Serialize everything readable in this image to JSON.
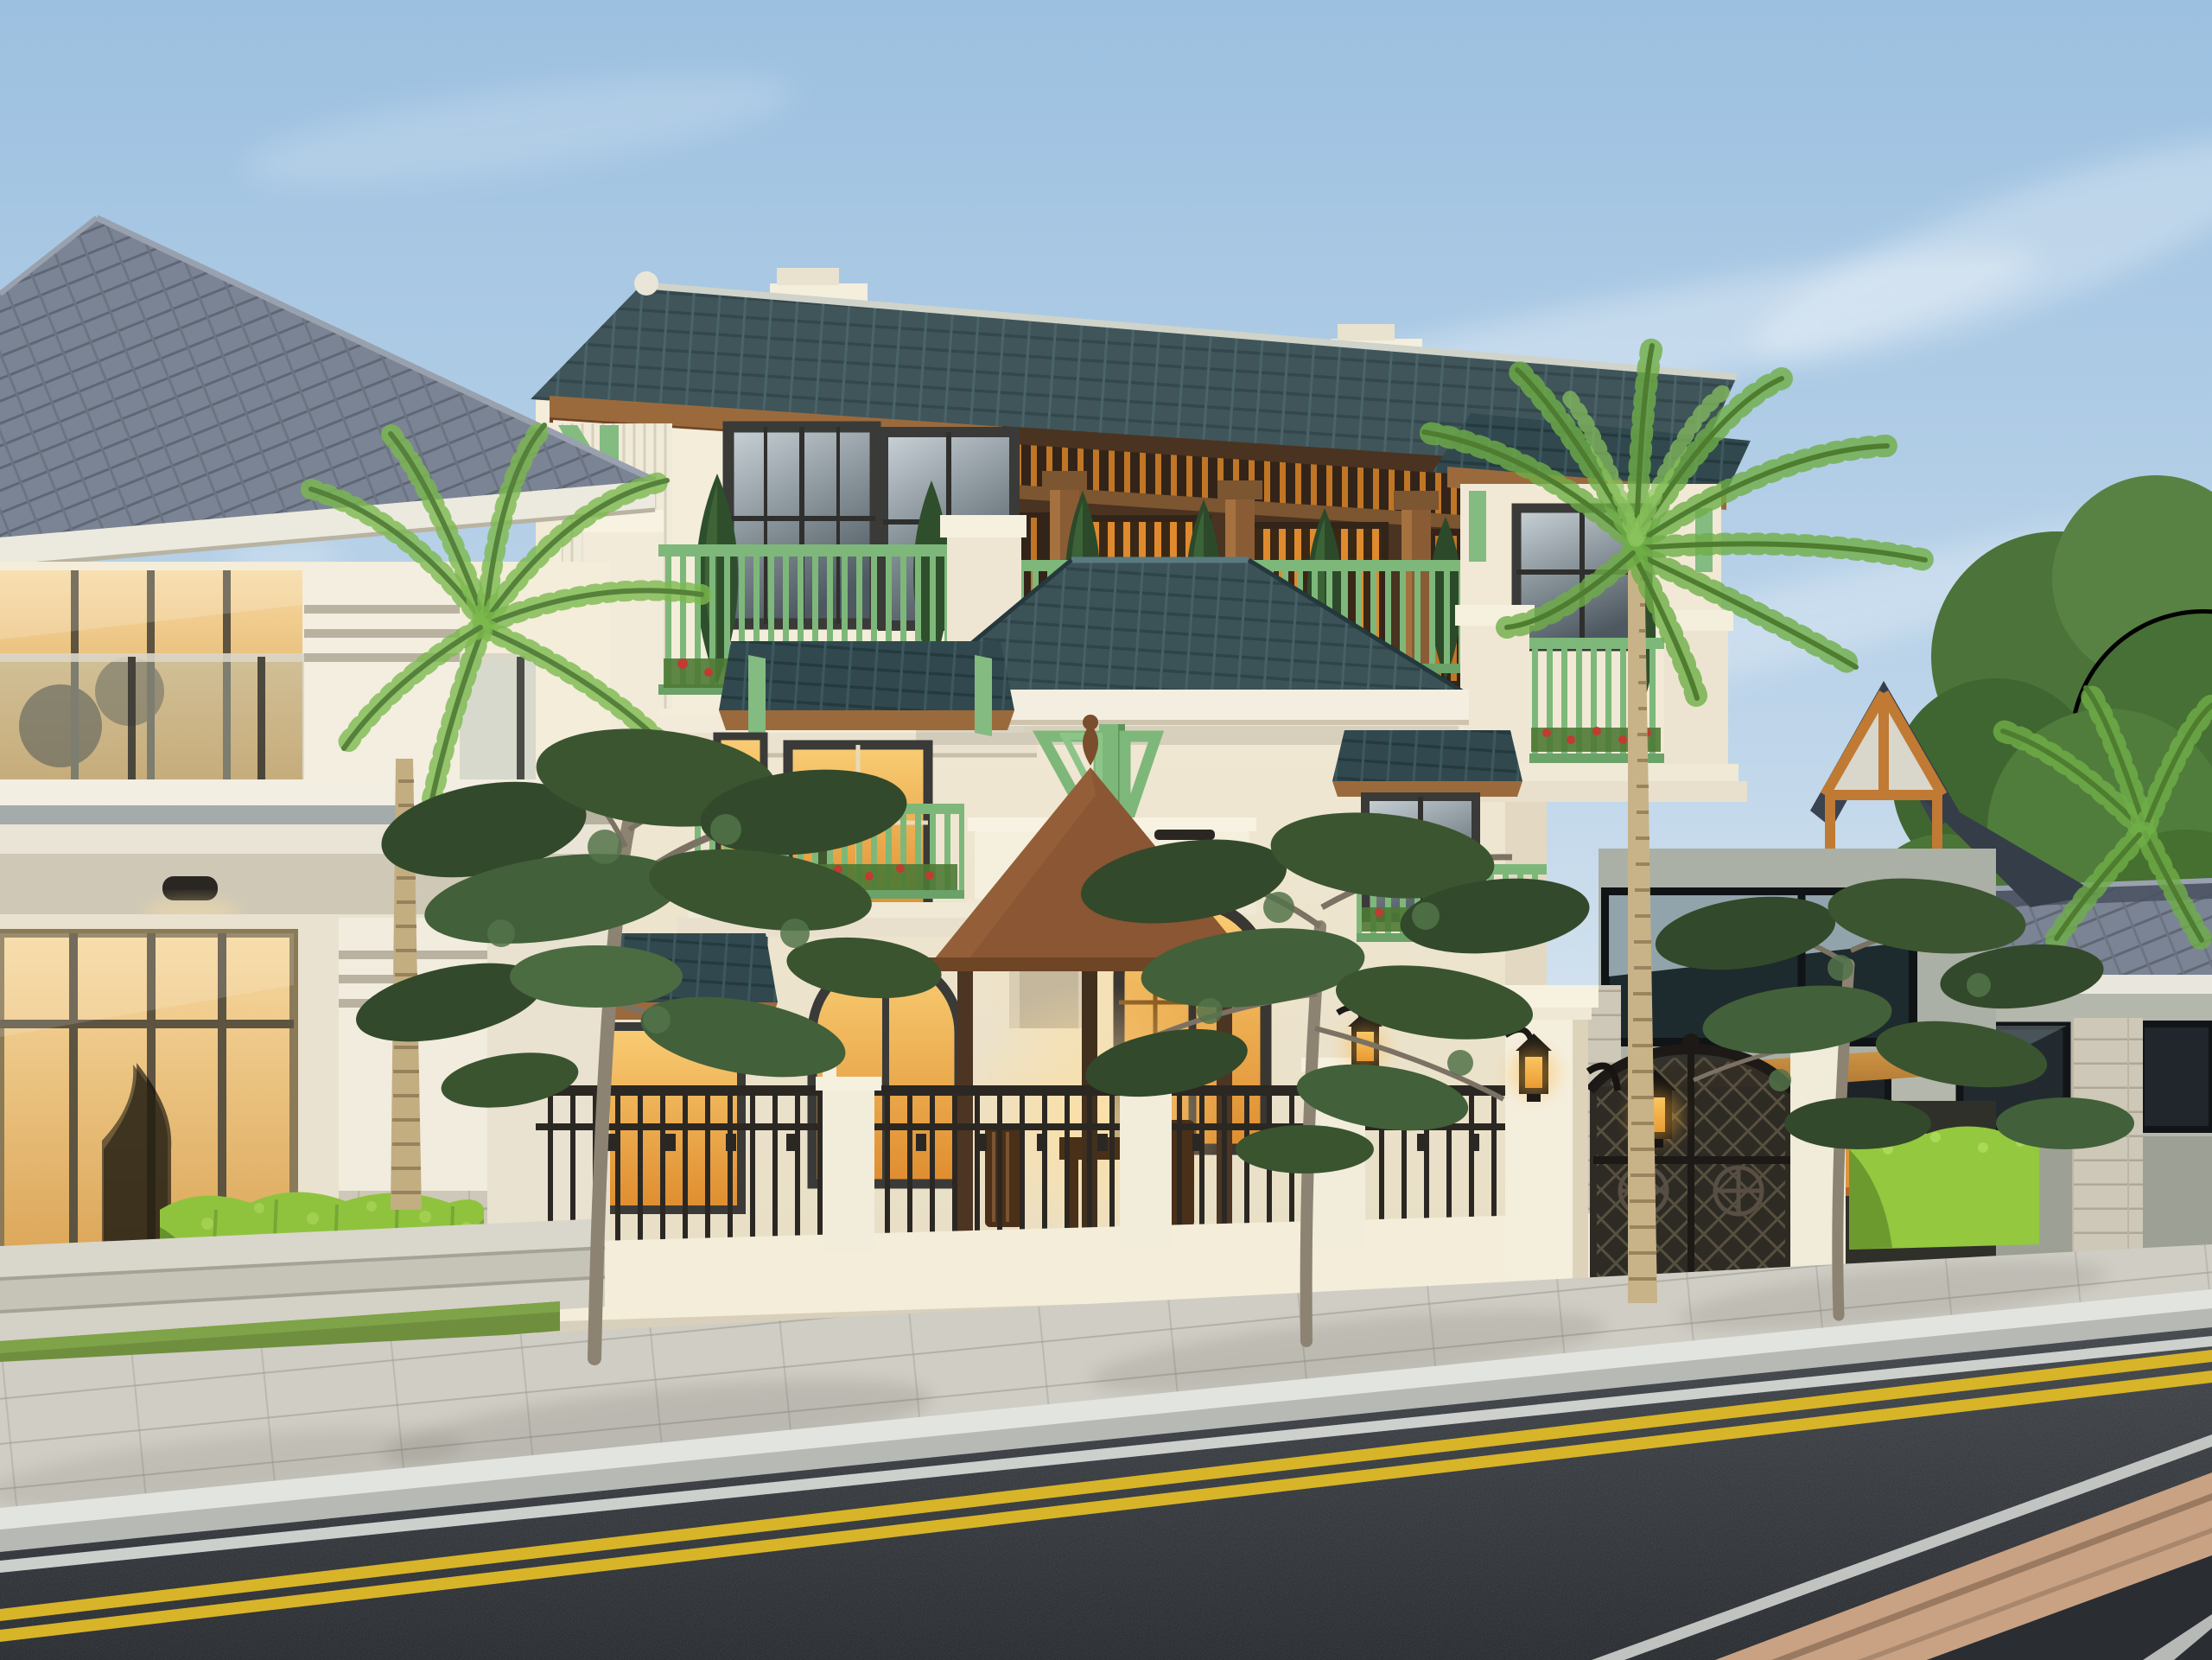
{
  "scene": {
    "title": "Street-front architectural render of a tropical neoclassical villa at dusk",
    "time_of_day": "early evening, warm interior lights on",
    "weather": "clear sky with thin wispy clouds",
    "elements": {
      "sky": "pale blue gradient sky with white cloud streaks",
      "left_house": "modern cream two-storey house with large gray hip tile roof, glass facade and thick square column",
      "main_villa": "three-storey cream villa with dark teal tile roofs, wooden lit loggia, green railings and green brackets",
      "loggia": "top-floor timber loggia with warm backlit vertical slats and round wood columns",
      "balconies": "green painted railings with red flower boxes and conical cypress shrubs",
      "gazebo": "brown wooden pavilion with pyramidal shingle roof and table seating in the front yard",
      "fence": "low white masonry fence with black wrought-iron panels",
      "gate": "arched black wrought-iron double gate between white pillars with lit lanterns",
      "second_villa": "neighbouring house behind the gate with gable roof, timber truss and wooden carport canopy",
      "right_house": "single-storey gray house with dark hip roof, stone corner pillar and dark windows",
      "palms": "tall ringed-trunk coconut palms",
      "street_trees": "young street trees with sparse dark foliage along the sidewalk",
      "hedges": "bright yellow-green clipped hedges",
      "sidewalk": "light paver sidewalk with granite curb",
      "road": "dark asphalt road with double yellow centre line and white edge lines",
      "median_strip": "tan paved strip at lower right corner"
    },
    "lighting": [
      "warm orange glow in windows",
      "lantern flames on gate pillars",
      "recessed downlights under balconies"
    ]
  },
  "palette": {
    "sky_top": "#9cc0e0",
    "sky_horizon": "#edf1f4",
    "cloud": "#ffffff",
    "roof_teal": "#31494e",
    "roof_teal_dark": "#243a3f",
    "roof_gray": "#7b8494",
    "roof_slate": "#3a4350",
    "fascia_wood": "#9b6a3c",
    "wood_dark": "#6e4525",
    "wall_cream": "#f4edda",
    "wall_shadow": "#e7ddc6",
    "wall_gray": "#b4b7ab",
    "accent_green": "#84bb81",
    "railing_green": "#7db87a",
    "cypress_green": "#2f4f2c",
    "window_frame": "#3a3a38",
    "glass_sky": "#b9c4c9",
    "glass_warm": "#f2b04f",
    "loggia_wood": "#4a3320",
    "loggia_glow": "#e08a2e",
    "gazebo_roof": "#8a5633",
    "gazebo_wood": "#4c3523",
    "iron_dark": "#2b2824",
    "hedge_bright": "#8fc33e",
    "foliage_dark": "#33492b",
    "foliage_mid": "#4e6b3e",
    "palm_green": "#6aa844",
    "palm_trunk": "#c3ae82",
    "tree_trunk": "#8d8372",
    "sidewalk": "#cfcdc4",
    "curb": "#e2e4e0",
    "grass": "#6f8f3f",
    "road": "#2d3136",
    "marking_yellow": "#d8b428",
    "marking_white": "#d9dcd8",
    "median_tan": "#c9a183",
    "lantern_black": "#1d1a17",
    "lantern_glow": "#ffb63e",
    "flower_red": "#c13b30"
  }
}
